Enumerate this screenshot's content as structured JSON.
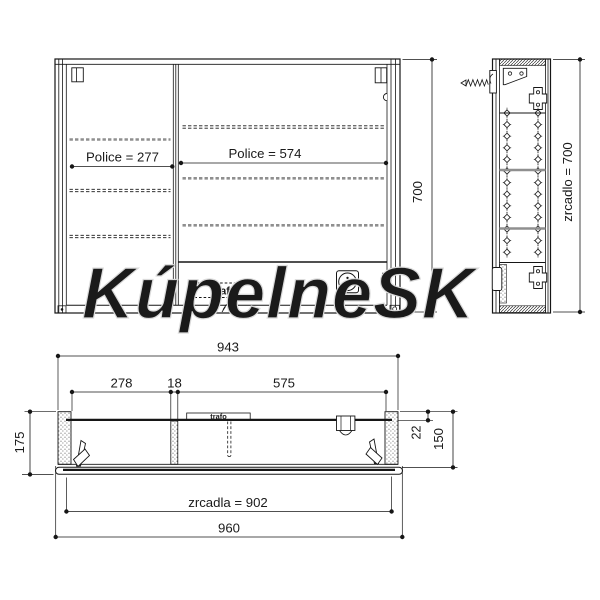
{
  "watermark": "KúpelneSK",
  "front_view": {
    "shelf_left_label": "Police = 277",
    "shelf_right_label": "Police = 574",
    "transformer_label": "trafo",
    "height_dim": "700"
  },
  "side_view": {
    "mirror_height_dim": "zrcadlo = 700"
  },
  "plan_view": {
    "carcass_width_dim": "943",
    "left_section_dim": "278",
    "divider_dim": "18",
    "right_section_dim": "575",
    "depth_total_dim": "175",
    "back_gap_dim": "22",
    "depth_carcass_dim": "150",
    "mirror_width_dim": "zrcadla = 902",
    "total_width_dim": "960",
    "transformer_label": "trafo"
  }
}
